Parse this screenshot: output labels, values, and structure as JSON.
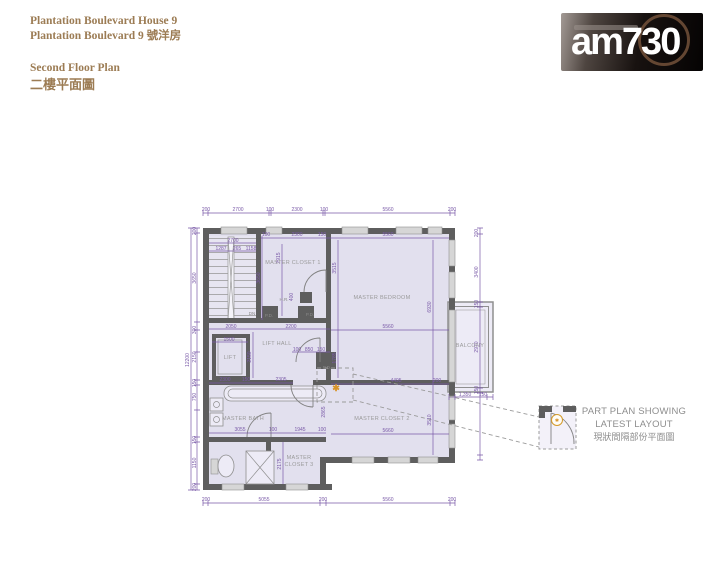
{
  "header": {
    "title_line1": "Plantation Boulevard House 9",
    "title_line2": "Plantation Boulevard 9 號洋房",
    "subtitle_line1": "Second Floor Plan",
    "subtitle_line2": "二樓平面圖",
    "accent_color": "#9c7c54"
  },
  "logo": {
    "wordmark": "am730"
  },
  "detail_note": {
    "line1": "PART PLAN SHOWING",
    "line2": "LATEST LAYOUT",
    "line3": "現狀間隔部份平面圖"
  },
  "floor_plan": {
    "marker": "✱",
    "icon_marker": "✱",
    "colors": {
      "dimension": "#7a5aa8",
      "wall": "#5e5e5e",
      "room_fill": "#e2e0ee",
      "room_label": "#9a9a9a",
      "accent_orange": "#d9952a"
    },
    "room_labels": [
      {
        "t": "MASTER CLOSET 1",
        "x": 293,
        "y": 264
      },
      {
        "t": "MASTER BEDROOM",
        "x": 382,
        "y": 299
      },
      {
        "t": "LIFT HALL",
        "x": 277,
        "y": 345
      },
      {
        "t": "LIFT",
        "x": 230,
        "y": 359
      },
      {
        "t": "MASTER BATH",
        "x": 243,
        "y": 420
      },
      {
        "t": "MASTER CLOSET 2",
        "x": 382,
        "y": 420
      },
      {
        "t": "MASTER",
        "x": 299,
        "y": 459
      },
      {
        "t": "CLOSET 3",
        "x": 299,
        "y": 466
      },
      {
        "t": "BALCONY",
        "x": 470,
        "y": 347
      }
    ],
    "utility_labels": [
      {
        "t": "DN",
        "x": 252,
        "y": 315
      },
      {
        "t": "P.D.",
        "x": 269,
        "y": 317
      },
      {
        "t": "P.D.",
        "x": 310,
        "y": 316
      },
      {
        "t": "H.R.",
        "x": 284,
        "y": 301
      },
      {
        "t": "P.D.",
        "x": 327,
        "y": 369
      }
    ],
    "dim_labels": [
      {
        "t": "200",
        "x": 206,
        "y": 211
      },
      {
        "t": "2700",
        "x": 238,
        "y": 211
      },
      {
        "t": "100",
        "x": 270,
        "y": 211
      },
      {
        "t": "2300",
        "x": 297,
        "y": 211
      },
      {
        "t": "100",
        "x": 324,
        "y": 211
      },
      {
        "t": "5560",
        "x": 388,
        "y": 211
      },
      {
        "t": "200",
        "x": 452,
        "y": 211
      },
      {
        "t": "100",
        "x": 266,
        "y": 236
      },
      {
        "t": "2300",
        "x": 297,
        "y": 236
      },
      {
        "t": "150",
        "x": 322,
        "y": 236
      },
      {
        "t": "5560",
        "x": 388,
        "y": 236
      },
      {
        "t": "200",
        "x": 206,
        "y": 501
      },
      {
        "t": "5055",
        "x": 264,
        "y": 501
      },
      {
        "t": "200",
        "x": 323,
        "y": 501
      },
      {
        "t": "5560",
        "x": 388,
        "y": 501
      },
      {
        "t": "200",
        "x": 452,
        "y": 501
      },
      {
        "t": "12200",
        "x": 189,
        "y": 360,
        "r": -90
      },
      {
        "t": "200",
        "x": 196,
        "y": 231,
        "r": -90
      },
      {
        "t": "3650",
        "x": 196,
        "y": 278,
        "r": -90
      },
      {
        "t": "300",
        "x": 196,
        "y": 330,
        "r": -90
      },
      {
        "t": "2150",
        "x": 196,
        "y": 357,
        "r": -90
      },
      {
        "t": "150",
        "x": 196,
        "y": 383,
        "r": -90
      },
      {
        "t": "750",
        "x": 196,
        "y": 397,
        "r": -90
      },
      {
        "t": "150",
        "x": 196,
        "y": 440,
        "r": -90
      },
      {
        "t": "1150",
        "x": 196,
        "y": 463,
        "r": -90
      },
      {
        "t": "200",
        "x": 196,
        "y": 487,
        "r": -90
      },
      {
        "t": "200",
        "x": 478,
        "y": 233,
        "r": -90
      },
      {
        "t": "3400",
        "x": 478,
        "y": 272,
        "r": -90
      },
      {
        "t": "150",
        "x": 478,
        "y": 304,
        "r": -90
      },
      {
        "t": "2970",
        "x": 478,
        "y": 347,
        "r": -90
      },
      {
        "t": "150",
        "x": 478,
        "y": 390,
        "r": -90
      },
      {
        "t": "1,350",
        "x": 465,
        "y": 396
      },
      {
        "t": "150",
        "x": 483,
        "y": 396
      },
      {
        "t": "2700",
        "x": 233,
        "y": 242
      },
      {
        "t": "1287",
        "x": 221,
        "y": 250
      },
      {
        "t": "265",
        "x": 237,
        "y": 250
      },
      {
        "t": "1158",
        "x": 251,
        "y": 250
      },
      {
        "t": "3650",
        "x": 260,
        "y": 278,
        "r": -90
      },
      {
        "t": "2915",
        "x": 280,
        "y": 258,
        "r": -90
      },
      {
        "t": "400",
        "x": 293,
        "y": 297,
        "r": -90
      },
      {
        "t": "3515",
        "x": 336,
        "y": 268,
        "r": -90
      },
      {
        "t": "1785",
        "x": 336,
        "y": 358,
        "r": -90
      },
      {
        "t": "6930",
        "x": 431,
        "y": 307,
        "r": -90
      },
      {
        "t": "5560",
        "x": 388,
        "y": 328
      },
      {
        "t": "2050",
        "x": 231,
        "y": 328
      },
      {
        "t": "2200",
        "x": 291,
        "y": 328
      },
      {
        "t": "1500",
        "x": 229,
        "y": 341
      },
      {
        "t": "2150",
        "x": 251,
        "y": 357,
        "r": -90
      },
      {
        "t": "100",
        "x": 297,
        "y": 351
      },
      {
        "t": "850",
        "x": 309,
        "y": 351
      },
      {
        "t": "150",
        "x": 321,
        "y": 351
      },
      {
        "t": "2300",
        "x": 225,
        "y": 381
      },
      {
        "t": "150",
        "x": 246,
        "y": 381
      },
      {
        "t": "2305",
        "x": 281,
        "y": 381
      },
      {
        "t": "4495",
        "x": 396,
        "y": 382
      },
      {
        "t": "200",
        "x": 437,
        "y": 382
      },
      {
        "t": "2865",
        "x": 325,
        "y": 412,
        "r": -90
      },
      {
        "t": "3510",
        "x": 431,
        "y": 420,
        "r": -90
      },
      {
        "t": "5660",
        "x": 388,
        "y": 432
      },
      {
        "t": "3055",
        "x": 240,
        "y": 431
      },
      {
        "t": "100",
        "x": 273,
        "y": 431
      },
      {
        "t": "1945",
        "x": 300,
        "y": 431
      },
      {
        "t": "100",
        "x": 322,
        "y": 431
      },
      {
        "t": "2175",
        "x": 281,
        "y": 464,
        "r": -90
      }
    ]
  }
}
